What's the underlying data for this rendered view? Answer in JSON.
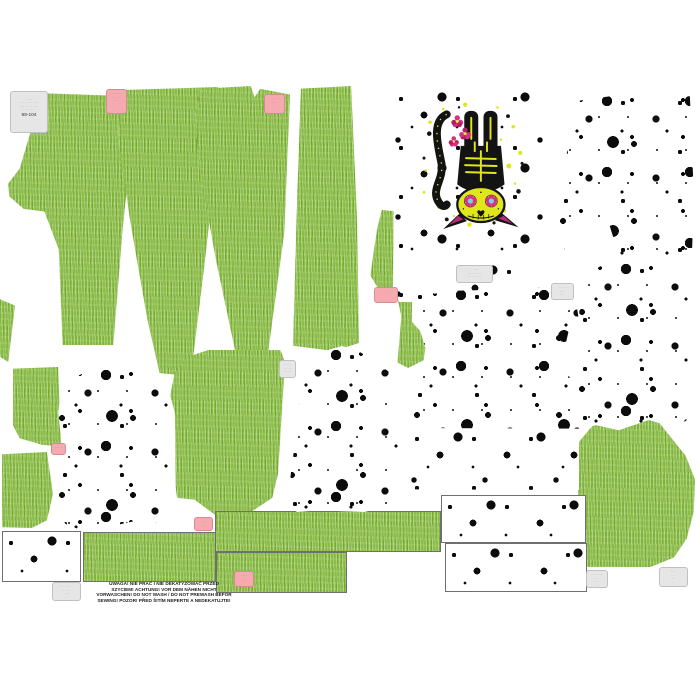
{
  "panel": {
    "warning_text": "UWAGA! NIE PRAĆ I NIE DEKATYZOWAĆ PRZED\nSZYCIEM! ACHTUNG! VOR DEM NÄHEN NICHT\nVORWASCHEN! DO NOT WASH / DO NOT PREWASH  BEFOR\nSEWING! POZOR! PŘED ŠITÍM NEPERTE A  NEDEKATUJTE!",
    "size": "98-104"
  },
  "labels": {
    "l1": {
      "lines": "· ····\n··· ·· ····· ·····\n···· ··· ·· ····\n·· ····· ··"
    },
    "l2": {
      "lines": "···· ···\n··· ··\n··"
    },
    "l3": {
      "lines": "·· ···\n··· ·"
    },
    "l4": {
      "lines": "·· ··"
    },
    "l5": {
      "lines": "· ·····\n···· · ····\n··· ···· ···"
    },
    "l6": {
      "lines": "·· ···\n··· ·\n····"
    },
    "l7": {
      "lines": "··· ··"
    },
    "l8": {
      "lines": "···\n··"
    },
    "l9": {
      "lines": "··· ·· ····\n·· ··· ·\n· ···\n··"
    },
    "l10": {
      "lines": "· ···\n·· ·"
    },
    "l11": {
      "lines": "····· ···\n·· · ··\n···\n· ··"
    },
    "l12": {
      "lines": "····\n·· ·\n··\n··"
    },
    "l13": {
      "lines": "· ····\n··· ··\n·· ···"
    }
  },
  "colors": {
    "fabric_green": "#8abd45",
    "splatter_black": "#0c0c0c",
    "label_pink_bg": "#f5aab0",
    "label_gray_bg": "#e6e6e6",
    "cat_yellow": "#dfe61a",
    "cat_pink": "#d62f86",
    "cat_black": "#131313"
  },
  "graphic": {
    "name": "sugar-skull-cat"
  }
}
